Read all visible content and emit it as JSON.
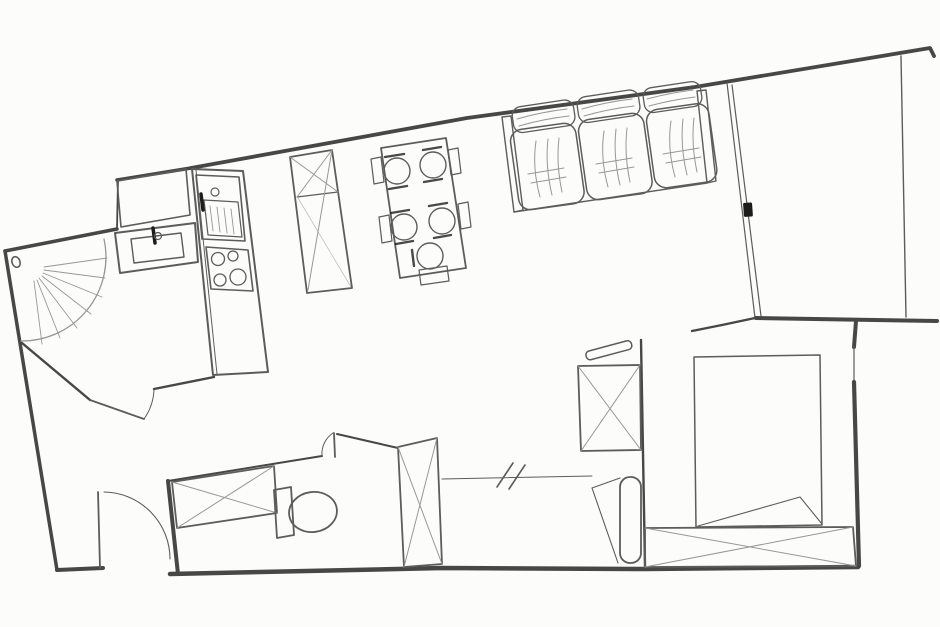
{
  "meta": {
    "canvas_width": 940,
    "canvas_height": 627,
    "kind": "hand-drawn-floor-plan-sketch"
  },
  "palette": {
    "paper": "#fcfcfa",
    "wall": "#474747",
    "line": "#5c5c5c",
    "light": "#979797",
    "dark": "#1c1c1c"
  },
  "elements": [
    {
      "n": "wall-outer-topleft",
      "d": "M5 251 L117 229",
      "w": 3.5,
      "s": "wall"
    },
    {
      "n": "wall-jog",
      "d": "M117 229 L118 180",
      "w": 1.8,
      "s": "wall"
    },
    {
      "n": "wall-top-kitchen",
      "d": "M117 180 L191 168",
      "w": 3.5,
      "s": "wall"
    },
    {
      "n": "wall-top-main",
      "d": "M191 168 L467 118 L695 87 L930 48 L934 56",
      "w": 3.8,
      "s": "wall"
    },
    {
      "n": "wall-outer-left",
      "d": "M5 251 L57 570",
      "w": 3.5,
      "s": "wall"
    },
    {
      "n": "wall-bottom-left",
      "d": "M57 570 L103 568",
      "w": 4,
      "s": "wall"
    },
    {
      "n": "entry-door-leaf",
      "d": "M100 568 L98 492",
      "w": 1.8
    },
    {
      "n": "entry-door-arc",
      "d": "M104 492 A67 67 0 0 1 170 559",
      "w": 1.1
    },
    {
      "n": "wall-shower-inner",
      "d": "M22 343 L90 400",
      "w": 2.4,
      "s": "wall"
    },
    {
      "n": "hall-door-leaf",
      "d": "M90 400 L144 419",
      "w": 1.8
    },
    {
      "n": "hall-door-arc",
      "d": "M144 419 A55 55 0 0 0 154 390",
      "w": 1
    },
    {
      "n": "wall-hall-top",
      "d": "M154 389 L214 377",
      "w": 2.4,
      "s": "wall"
    },
    {
      "n": "wall-bath-left",
      "d": "M168 481 L178 574",
      "w": 4,
      "s": "wall"
    },
    {
      "n": "wall-bath-top",
      "d": "M168 481 L322 456",
      "w": 2,
      "s": "wall"
    },
    {
      "n": "bath-door-leaf",
      "d": "M334 433 L335 457",
      "w": 1.8
    },
    {
      "n": "bath-door-arc",
      "d": "M333 433 A25 25 0 0 0 322 456",
      "w": 1
    },
    {
      "n": "wall-bath-right",
      "d": "M337 434 L398 448",
      "w": 2,
      "s": "wall"
    },
    {
      "n": "wall-bottom",
      "d": "M170 574 L442 568 L645 569 L858 567",
      "w": 4.5,
      "s": "wall"
    },
    {
      "n": "wall-corridor-bedroom",
      "d": "M641 340 L645 566",
      "w": 2.4,
      "s": "wall"
    },
    {
      "n": "wall-bedroom-top",
      "d": "M692 331 L722 325 L755 318",
      "w": 2.4,
      "s": "wall"
    },
    {
      "n": "glass-wall-line-1",
      "d": "M727 83 L755 318",
      "w": 1.2
    },
    {
      "n": "glass-wall-line-2",
      "d": "M732 85 L761 316",
      "w": 1.2
    },
    {
      "n": "wall-balcony-bottom",
      "d": "M756 318 L937 321",
      "w": 4,
      "s": "wall"
    },
    {
      "n": "wall-balcony-right",
      "d": "M901 56 L906 317",
      "w": 1.4
    },
    {
      "n": "wall-bedroom-right-stub",
      "d": "M856 321 L854 347",
      "w": 4,
      "s": "wall"
    },
    {
      "n": "bedroom-window-line",
      "d": "M854 347 L854 382",
      "w": 1.2
    },
    {
      "n": "wall-bedroom-right",
      "d": "M854 382 L859 566",
      "w": 4.2,
      "s": "wall"
    },
    {
      "n": "opening-line",
      "d": "M442 479 L592 476",
      "w": 1
    },
    {
      "n": "opening-slash-1",
      "d": "M497 487 L513 463",
      "w": 1.6
    },
    {
      "n": "opening-slash-2",
      "d": "M509 489 L525 465",
      "w": 1.6
    },
    {
      "n": "door-knob",
      "t": "ellipse",
      "cx": 16,
      "cy": 262,
      "rx": 4,
      "ry": 5.5,
      "rot": -20,
      "w": 1.6
    },
    {
      "n": "shower-arc",
      "d": "M104 239 A84 84 0 0 1 21 341",
      "w": 1.3,
      "s": "light"
    },
    {
      "n": "shower-ray-1",
      "d": "M44 267 L107 258",
      "w": 0.9,
      "s": "light"
    },
    {
      "n": "shower-ray-2",
      "d": "M44 270 L105 278",
      "w": 0.9,
      "s": "light"
    },
    {
      "n": "shower-ray-3",
      "d": "M43 273 L102 297",
      "w": 0.9,
      "s": "light"
    },
    {
      "n": "shower-ray-4",
      "d": "M42 276 L91 314",
      "w": 0.9,
      "s": "light"
    },
    {
      "n": "shower-ray-5",
      "d": "M39 278 L77 328",
      "w": 0.9,
      "s": "light"
    },
    {
      "n": "shower-ray-6",
      "d": "M37 280 L60 338",
      "w": 0.9,
      "s": "light"
    },
    {
      "n": "shower-ray-7",
      "d": "M34 281 L42 344",
      "w": 0.9,
      "s": "light"
    },
    {
      "n": "vanity-counter",
      "d": "M115 233 L195 223 L198 262 L120 273 Z",
      "w": 2
    },
    {
      "n": "vanity-basin",
      "d": "M131 239 L181 233 L184 257 L134 263 Z",
      "w": 1.4
    },
    {
      "n": "vanity-faucet",
      "d": "M153 228 L155 243",
      "w": 3.5,
      "s": "dark"
    },
    {
      "n": "vanity-faucet-ring",
      "t": "circle",
      "cx": 158,
      "cy": 236,
      "r": 3.5,
      "w": 1.2
    },
    {
      "n": "kitchen-cupboard",
      "d": "M117 181 L186 169 L190 215 L121 227 Z",
      "w": 1.6
    },
    {
      "n": "kitchen-counter",
      "d": "M192 169 L243 171 L268 372 L213 375 Z",
      "w": 2
    },
    {
      "n": "kitchen-counter-edge",
      "d": "M196 170 L217 374",
      "w": 1
    },
    {
      "n": "sink-unit",
      "d": "M196 175 L239 177 L245 241 L202 239 Z",
      "w": 1.6
    },
    {
      "n": "sink-basin",
      "d": "M204 200 L238 202 L242 237 L208 235 Z",
      "w": 1.2
    },
    {
      "n": "sink-hatch-1",
      "d": "M210 206 L213 231",
      "w": 0.9,
      "s": "light"
    },
    {
      "n": "sink-hatch-2",
      "d": "M217 207 L220 232",
      "w": 0.9,
      "s": "light"
    },
    {
      "n": "sink-hatch-3",
      "d": "M224 208 L227 233",
      "w": 0.9,
      "s": "light"
    },
    {
      "n": "sink-hatch-4",
      "d": "M231 209 L234 234",
      "w": 0.9,
      "s": "light"
    },
    {
      "n": "sink-faucet",
      "d": "M201 194 L203 210",
      "w": 3.5,
      "s": "dark"
    },
    {
      "n": "sink-knob",
      "t": "circle",
      "cx": 215,
      "cy": 192,
      "r": 4,
      "w": 1.2
    },
    {
      "n": "stove",
      "d": "M206 247 L248 250 L253 291 L211 289 Z",
      "w": 1.6
    },
    {
      "n": "burner-1",
      "t": "circle",
      "cx": 218,
      "cy": 259,
      "r": 6.5,
      "w": 1.3
    },
    {
      "n": "burner-2",
      "t": "circle",
      "cx": 233,
      "cy": 256,
      "r": 5,
      "w": 1.3
    },
    {
      "n": "burner-3",
      "t": "circle",
      "cx": 220,
      "cy": 280,
      "r": 6,
      "w": 1.3
    },
    {
      "n": "burner-4",
      "t": "circle",
      "cx": 238,
      "cy": 277,
      "r": 8,
      "w": 1.3
    },
    {
      "n": "tall-cabinet",
      "d": "M290 157 L332 150 L352 288 L307 293 Z",
      "w": 1.8
    },
    {
      "n": "tall-cabinet-shelf",
      "d": "M297 197 L338 192",
      "w": 1.2
    },
    {
      "n": "tall-cabinet-x-1",
      "d": "M290 157 L338 192",
      "w": 1,
      "s": "light"
    },
    {
      "n": "tall-cabinet-x-2",
      "d": "M332 150 L297 197",
      "w": 1,
      "s": "light"
    },
    {
      "n": "tall-cabinet-diag-1",
      "d": "M332 150 L308 290",
      "w": 1,
      "s": "light"
    },
    {
      "n": "tall-cabinet-diag-2",
      "d": "M298 198 L351 287",
      "w": 0.8,
      "s": "light",
      "o": 0.6
    },
    {
      "n": "dining-table",
      "d": "M381 148 L446 138 L466 268 L400 278 Z",
      "w": 1.8
    },
    {
      "n": "dining-chair-1",
      "t": "circle",
      "cx": 397,
      "cy": 171,
      "r": 13,
      "w": 1.4
    },
    {
      "n": "dining-chair-2",
      "t": "circle",
      "cx": 433,
      "cy": 165,
      "r": 13,
      "w": 1.4
    },
    {
      "n": "dining-chair-3",
      "t": "circle",
      "cx": 404,
      "cy": 227,
      "r": 13,
      "w": 1.4
    },
    {
      "n": "dining-chair-4",
      "t": "circle",
      "cx": 442,
      "cy": 221,
      "r": 13,
      "w": 1.4
    },
    {
      "n": "dining-chair-5",
      "t": "circle",
      "cx": 430,
      "cy": 256,
      "r": 13,
      "w": 1.4
    },
    {
      "n": "table-tab-left-1",
      "d": "M371 159 L381 157 L384 182 L374 184 Z",
      "w": 1.2
    },
    {
      "n": "table-tab-left-2",
      "d": "M379 217 L389 215 L392 241 L382 243 Z",
      "w": 1.2
    },
    {
      "n": "table-tab-right-1",
      "d": "M448 150 L458 148 L461 173 L451 175 Z",
      "w": 1.2
    },
    {
      "n": "table-tab-right-2",
      "d": "M458 204 L468 202 L471 227 L461 229 Z",
      "w": 1.2
    },
    {
      "n": "table-tab-bottom",
      "d": "M419 270 L447 266 L449 281 L421 285 Z",
      "w": 1.2
    },
    {
      "n": "chair-back-tick-1",
      "d": "M385 157 L404 154",
      "w": 2.4,
      "s": "dark",
      "o": 0.8
    },
    {
      "n": "chair-back-tick-2",
      "d": "M389 189 L407 186",
      "w": 2.4,
      "s": "dark",
      "o": 0.8
    },
    {
      "n": "chair-back-tick-3",
      "d": "M423 150 L441 147",
      "w": 2.4,
      "s": "dark",
      "o": 0.8
    },
    {
      "n": "chair-back-tick-4",
      "d": "M424 182 L442 179",
      "w": 2.4,
      "s": "dark",
      "o": 0.8
    },
    {
      "n": "chair-back-tick-5",
      "d": "M391 213 L409 210",
      "w": 2.4,
      "s": "dark",
      "o": 0.8
    },
    {
      "n": "chair-back-tick-6",
      "d": "M396 244 L413 241",
      "w": 2.4,
      "s": "dark",
      "o": 0.8
    },
    {
      "n": "chair-back-tick-7",
      "d": "M429 206 L447 203",
      "w": 2.4,
      "s": "dark",
      "o": 0.8
    },
    {
      "n": "chair-back-tick-8",
      "d": "M434 238 L451 235",
      "w": 2.4,
      "s": "dark",
      "o": 0.8
    },
    {
      "n": "chair-back-tick-9",
      "d": "M412 250 L414 266",
      "w": 2.4,
      "s": "dark",
      "o": 0.8
    },
    {
      "n": "sofa-arm-left",
      "d": "M502 117 L511 116 L523 210 L514 212 Z",
      "w": 1.4
    },
    {
      "n": "sofa-arm-right",
      "d": "M697 91 L706 90 L716 181 L707 183 Z",
      "w": 1.4
    },
    {
      "n": "sofa-front-edge",
      "d": "M514 212 L707 183",
      "w": 1.4
    },
    {
      "n": "sofa-back-cushion-1",
      "t": "rrect",
      "x": 511,
      "y": 108,
      "wd": 62,
      "ht": 26,
      "rx": 9,
      "rot": -8.5,
      "w": 1.3
    },
    {
      "n": "sofa-back-cushion-2",
      "t": "rrect",
      "x": 576,
      "y": 98,
      "wd": 62,
      "ht": 26,
      "rx": 9,
      "rot": -8.5,
      "w": 1.3
    },
    {
      "n": "sofa-back-cushion-3",
      "t": "rrect",
      "x": 642,
      "y": 89,
      "wd": 58,
      "ht": 25,
      "rx": 9,
      "rot": -8.5,
      "w": 1.3
    },
    {
      "n": "sofa-seat-cushion-1",
      "t": "rrect",
      "x": 509,
      "y": 131,
      "wd": 66,
      "ht": 81,
      "rx": 12,
      "rot": -8,
      "w": 1.5
    },
    {
      "n": "sofa-seat-cushion-2",
      "t": "rrect",
      "x": 577,
      "y": 121,
      "wd": 66,
      "ht": 81,
      "rx": 12,
      "rot": -8,
      "w": 1.5
    },
    {
      "n": "sofa-seat-cushion-3",
      "t": "rrect",
      "x": 645,
      "y": 111,
      "wd": 63,
      "ht": 79,
      "rx": 12,
      "rot": -8,
      "w": 1.5
    },
    {
      "n": "sofa-fabric-line-1",
      "d": "M536 141 Q532 168 540 197",
      "w": 1,
      "s": "light"
    },
    {
      "n": "sofa-fabric-line-2",
      "d": "M548 139 Q545 166 552 195",
      "w": 1,
      "s": "light"
    },
    {
      "n": "sofa-fabric-line-3",
      "d": "M559 138 Q556 164 562 192",
      "w": 1,
      "s": "light"
    },
    {
      "n": "sofa-fabric-line-4",
      "d": "M528 174 L564 168",
      "w": 1,
      "s": "light"
    },
    {
      "n": "sofa-fabric-line-5",
      "d": "M531 183 L566 177",
      "w": 1,
      "s": "light"
    },
    {
      "n": "sofa-fabric-line-6",
      "d": "M604 131 Q600 158 608 187",
      "w": 1,
      "s": "light"
    },
    {
      "n": "sofa-fabric-line-7",
      "d": "M616 129 Q613 156 620 185",
      "w": 1,
      "s": "light"
    },
    {
      "n": "sofa-fabric-line-8",
      "d": "M627 128 Q624 154 630 182",
      "w": 1,
      "s": "light"
    },
    {
      "n": "sofa-fabric-line-9",
      "d": "M596 164 L632 158",
      "w": 1,
      "s": "light"
    },
    {
      "n": "sofa-fabric-line-10",
      "d": "M599 173 L634 167",
      "w": 1,
      "s": "light"
    },
    {
      "n": "sofa-fabric-line-11",
      "d": "M671 121 Q667 148 675 177",
      "w": 1,
      "s": "light"
    },
    {
      "n": "sofa-fabric-line-12",
      "d": "M683 119 Q680 146 687 175",
      "w": 1,
      "s": "light"
    },
    {
      "n": "sofa-fabric-line-13",
      "d": "M694 118 Q691 144 697 172",
      "w": 1,
      "s": "light"
    },
    {
      "n": "sofa-fabric-line-14",
      "d": "M663 154 L699 148",
      "w": 1,
      "s": "light"
    },
    {
      "n": "sofa-fabric-line-15",
      "d": "M666 163 L701 157",
      "w": 1,
      "s": "light"
    },
    {
      "n": "sofa-fabric-line-16",
      "d": "M517 119 Q541 112 567 109",
      "w": 1,
      "s": "light"
    },
    {
      "n": "sofa-fabric-line-17",
      "d": "M519 126 Q543 119 569 116",
      "w": 1,
      "s": "light"
    },
    {
      "n": "sofa-fabric-line-18",
      "d": "M582 109 Q606 102 632 99",
      "w": 1,
      "s": "light"
    },
    {
      "n": "sofa-fabric-line-19",
      "d": "M584 116 Q608 109 634 106",
      "w": 1,
      "s": "light"
    },
    {
      "n": "sofa-fabric-line-20",
      "d": "M647 99 Q669 93 693 90",
      "w": 1,
      "s": "light"
    },
    {
      "n": "sofa-fabric-line-21",
      "d": "M649 106 Q671 100 695 97",
      "w": 1,
      "s": "light"
    },
    {
      "n": "balcony-door-handle",
      "t": "rrect",
      "x": 743,
      "y": 203,
      "wd": 9,
      "ht": 14,
      "rx": 1.5,
      "rot": -4,
      "f": "dark",
      "w": 0
    },
    {
      "n": "bedroom-shelf",
      "t": "rrect",
      "x": 585,
      "y": 352,
      "wd": 47,
      "ht": 9,
      "rx": 4,
      "rot": -15,
      "w": 1.5
    },
    {
      "n": "bedroom-dresser",
      "d": "M578 366 L640 365 L641 450 L581 451 Z",
      "w": 1.8
    },
    {
      "n": "bedroom-dresser-x-1",
      "d": "M578 366 L641 450",
      "w": 1,
      "s": "light"
    },
    {
      "n": "bedroom-dresser-x-2",
      "d": "M640 365 L581 451",
      "w": 1,
      "s": "light"
    },
    {
      "n": "radiator",
      "t": "rrect",
      "x": 620,
      "y": 477,
      "wd": 21,
      "ht": 86,
      "rx": 10,
      "rot": 0,
      "w": 1.8
    },
    {
      "n": "door-wedge-line-1",
      "d": "M592 488 L618 563",
      "w": 1.1
    },
    {
      "n": "door-wedge-line-2",
      "d": "M592 488 L620 478",
      "w": 1.1
    },
    {
      "n": "bed",
      "d": "M694 357 L820 355 L822 525 L696 527 Z",
      "w": 1.5
    },
    {
      "n": "bed-blanket-fold",
      "d": "M698 526 L800 497 L822 524",
      "w": 1.1
    },
    {
      "n": "bedroom-wardrobe",
      "d": "M645 528 L853 527 L856 566 L645 567 Z",
      "w": 1.8
    },
    {
      "n": "bedroom-wardrobe-x-1",
      "d": "M645 528 L856 566",
      "w": 1,
      "s": "light"
    },
    {
      "n": "bedroom-wardrobe-x-2",
      "d": "M853 527 L645 567",
      "w": 1,
      "s": "light"
    },
    {
      "n": "washing-machine",
      "d": "M172 482 L274 466 L277 513 L177 528 Z",
      "w": 1.8
    },
    {
      "n": "washing-machine-x-1",
      "d": "M172 482 L277 513",
      "w": 1,
      "s": "light"
    },
    {
      "n": "washing-machine-x-2",
      "d": "M274 466 L177 528",
      "w": 1,
      "s": "light"
    },
    {
      "n": "toilet-cistern",
      "d": "M274 490 L291 487 L294 535 L277 538 Z",
      "w": 1.8
    },
    {
      "n": "toilet-bowl",
      "t": "ellipse",
      "cx": 313,
      "cy": 512,
      "rx": 24,
      "ry": 20,
      "rot": -8,
      "w": 1.8
    },
    {
      "n": "bath-wardrobe",
      "d": "M398 447 L437 438 L442 564 L404 567 Z",
      "w": 1.8
    },
    {
      "n": "bath-wardrobe-x-1",
      "d": "M398 447 L442 564",
      "w": 1,
      "s": "light"
    },
    {
      "n": "bath-wardrobe-x-2",
      "d": "M437 438 L404 567",
      "w": 1,
      "s": "light"
    }
  ]
}
